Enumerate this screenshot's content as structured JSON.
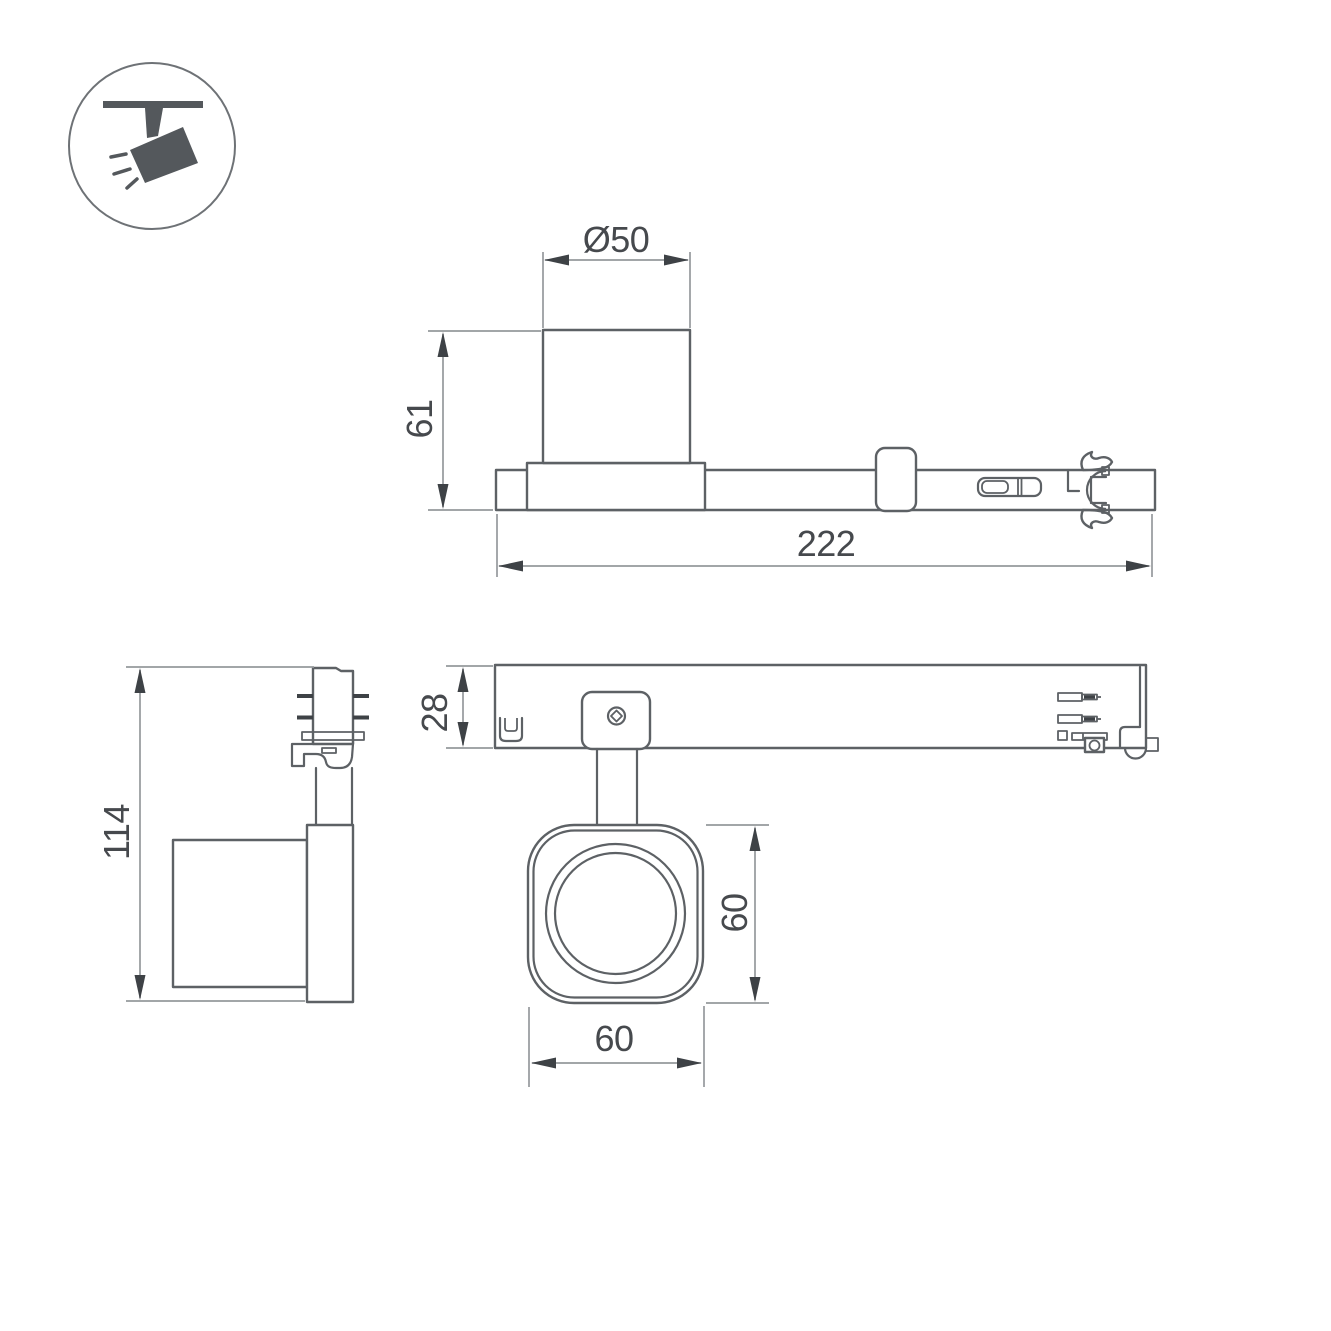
{
  "page": {
    "background": "#ffffff"
  },
  "palette": {
    "object_line": "#5d6165",
    "dimension_line": "#95999c",
    "text": "#46494d",
    "arrow_fill": "#3e4246",
    "icon_fill": "#54585c"
  },
  "icon": {
    "name": "ceiling-track-spotlight",
    "ray_count": 3
  },
  "views": {
    "side": {
      "name": "side-view",
      "dimensions": {
        "diameter_label": "Ø50",
        "height_label": "61",
        "length_label": "222"
      }
    },
    "front": {
      "name": "front-view",
      "dimensions": {
        "height_label": "114"
      }
    },
    "plan": {
      "name": "plan-view",
      "dimensions": {
        "track_depth_label": "28",
        "head_height_label": "60",
        "head_width_label": "60"
      }
    }
  }
}
